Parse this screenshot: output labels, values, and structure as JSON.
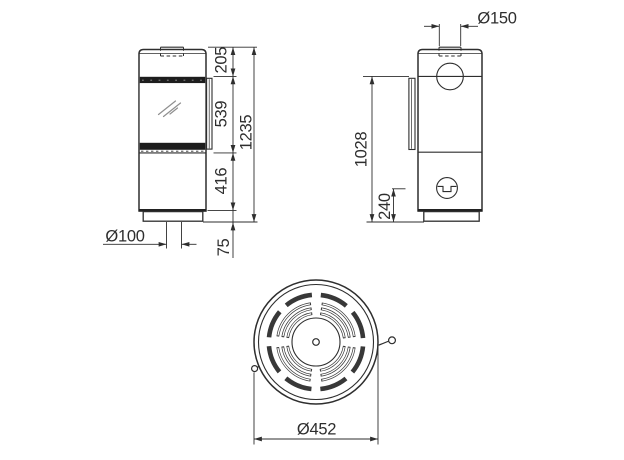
{
  "labels": {
    "d205": "205",
    "d539": "539",
    "d416": "416",
    "d75": "75",
    "d1235": "1235",
    "o100": "Ø100",
    "o150": "Ø150",
    "d1028": "1028",
    "d240": "240",
    "o452": "Ø452"
  },
  "colors": {
    "line": "#2e2e2e",
    "vent_band": "#1d1d1d",
    "background": "#ffffff"
  }
}
